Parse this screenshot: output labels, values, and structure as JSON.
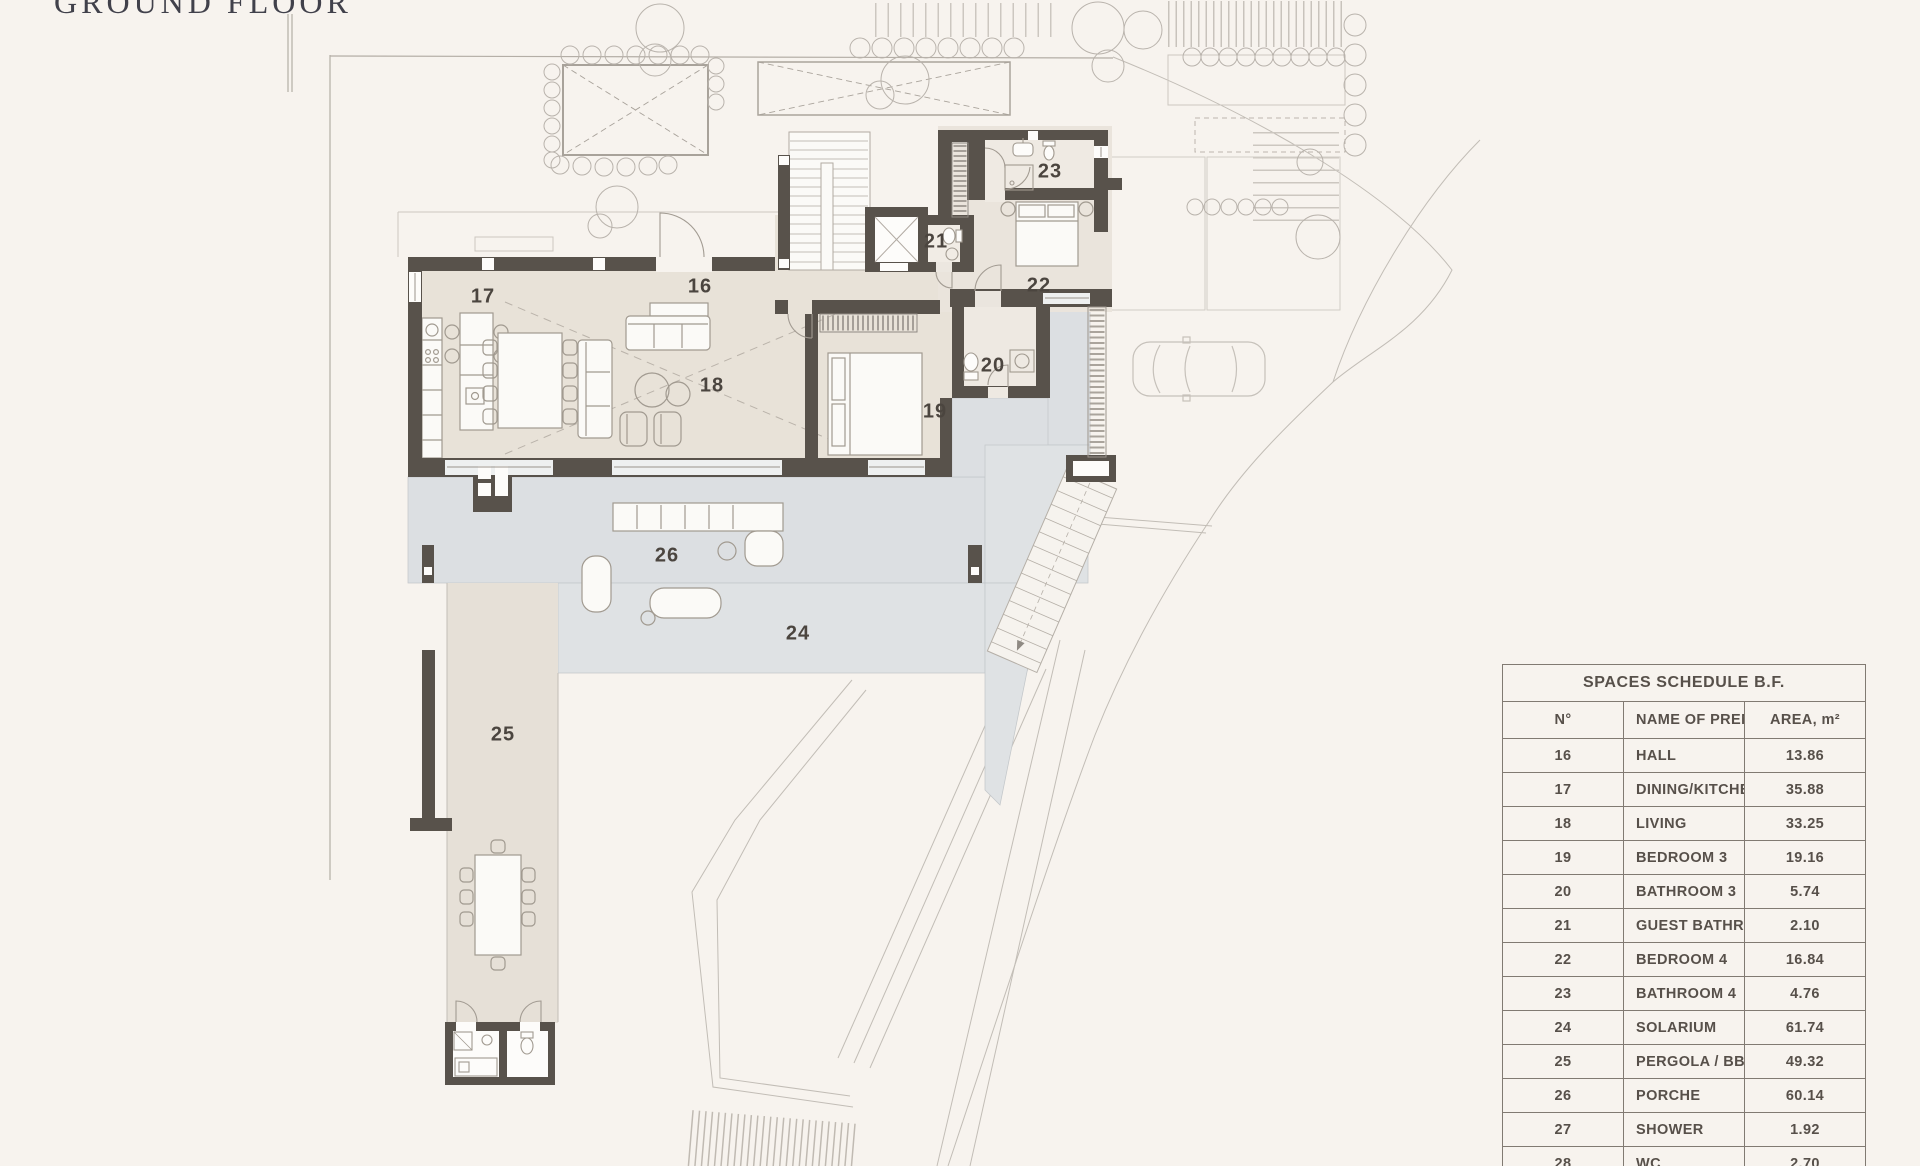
{
  "title": "GROUND FLOOR",
  "plan": {
    "room_labels": [
      {
        "n": "16",
        "x": 700,
        "y": 287
      },
      {
        "n": "17",
        "x": 483,
        "y": 297
      },
      {
        "n": "18",
        "x": 712,
        "y": 386
      },
      {
        "n": "19",
        "x": 935,
        "y": 412
      },
      {
        "n": "20",
        "x": 993,
        "y": 366
      },
      {
        "n": "21",
        "x": 936,
        "y": 242
      },
      {
        "n": "22",
        "x": 1039,
        "y": 286
      },
      {
        "n": "23",
        "x": 1050,
        "y": 172
      },
      {
        "n": "24",
        "x": 798,
        "y": 634
      },
      {
        "n": "25",
        "x": 503,
        "y": 735
      },
      {
        "n": "26",
        "x": 667,
        "y": 556
      }
    ]
  },
  "schedule": {
    "title": "SPACES SCHEDULE B.F.",
    "columns": [
      "N°",
      "NAME OF PREMISE",
      "AREA, m²"
    ],
    "rows": [
      [
        "16",
        "HALL",
        "13.86"
      ],
      [
        "17",
        "DINING/KITCHEN",
        "35.88"
      ],
      [
        "18",
        "LIVING",
        "33.25"
      ],
      [
        "19",
        "BEDROOM 3",
        "19.16"
      ],
      [
        "20",
        "BATHROOM 3",
        "5.74"
      ],
      [
        "21",
        "GUEST BATHROOM",
        "2.10"
      ],
      [
        "22",
        "BEDROOM 4",
        "16.84"
      ],
      [
        "23",
        "BATHROOM 4",
        "4.76"
      ],
      [
        "24",
        "SOLARIUM",
        "61.74"
      ],
      [
        "25",
        "PERGOLA / BBQ",
        "49.32"
      ],
      [
        "26",
        "PORCHE",
        "60.14"
      ],
      [
        "27",
        "SHOWER",
        "1.92"
      ],
      [
        "28",
        "WC",
        "2.70"
      ]
    ]
  }
}
